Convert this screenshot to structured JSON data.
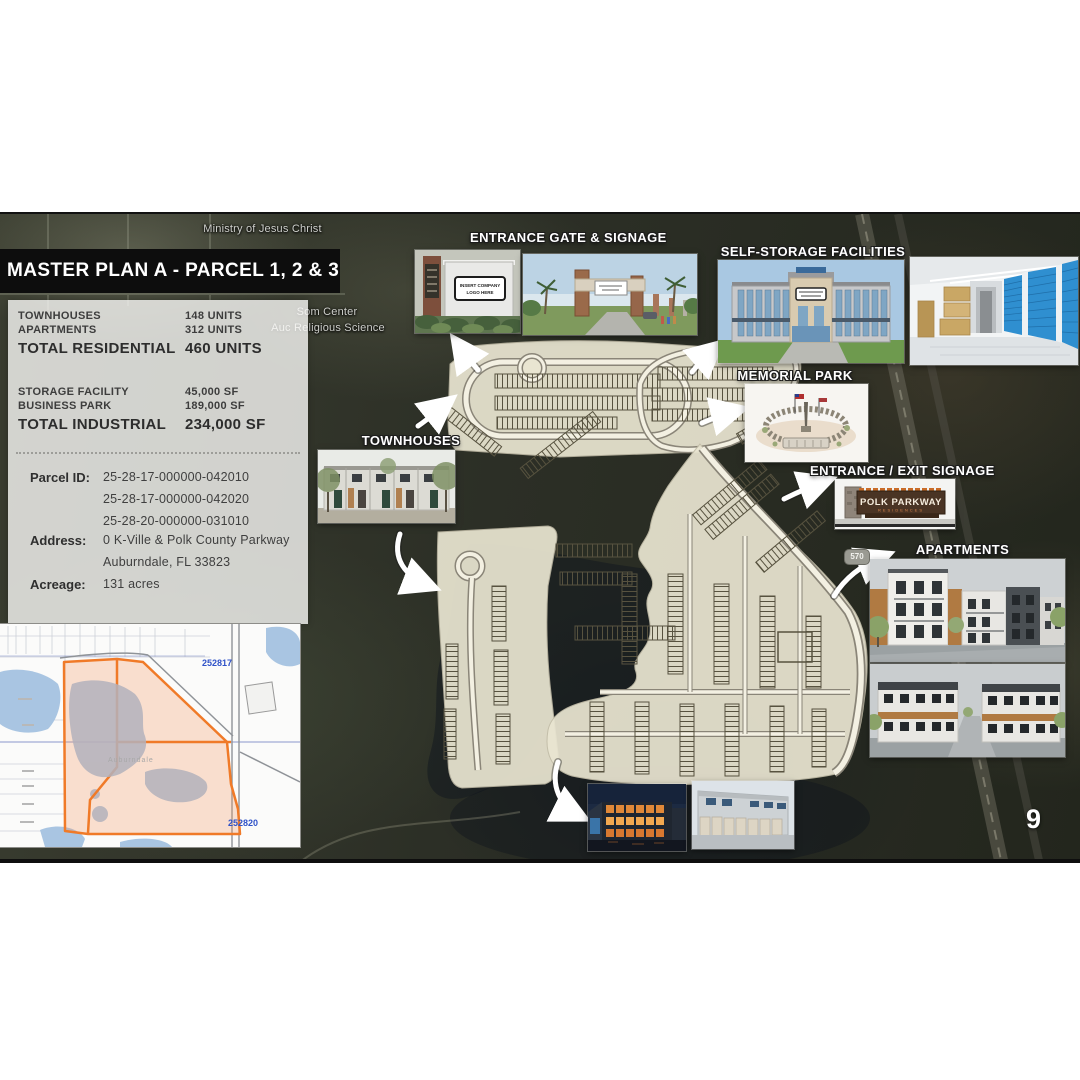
{
  "page_number": "9",
  "aerial": {
    "label_top": "Ministry of Jesus Christ",
    "label_mid1": "Som Center",
    "label_mid2": "Auc Religious Science",
    "road_badge": "570"
  },
  "info_panel": {
    "title": "MASTER PLAN A - PARCEL 1, 2 & 3",
    "residential": {
      "row1": {
        "label": "TOWNHOUSES",
        "value": "148 UNITS"
      },
      "row2": {
        "label": "APARTMENTS",
        "value": "312 UNITS"
      },
      "total": {
        "label": "TOTAL RESIDENTIAL",
        "value": "460 UNITS"
      }
    },
    "industrial": {
      "row1": {
        "label": "STORAGE FACILITY",
        "value": "45,000 SF"
      },
      "row2": {
        "label": "BUSINESS PARK",
        "value": "189,000 SF"
      },
      "total": {
        "label": "TOTAL INDUSTRIAL",
        "value": "234,000 SF"
      }
    },
    "parcel": {
      "label": "Parcel ID:",
      "id1": "25-28-17-000000-042010",
      "id2": "25-28-17-000000-042020",
      "id3": "25-28-20-000000-031010"
    },
    "address": {
      "label": "Address:",
      "line1": "0 K-Ville & Polk County Parkway",
      "line2": "Auburndale, FL 33823"
    },
    "acreage": {
      "label": "Acreage:",
      "value": "131 acres"
    }
  },
  "callouts": {
    "entrance_gate": "ENTRANCE GATE & SIGNAGE",
    "self_storage": "SELF-STORAGE FACILITIES",
    "memorial_park": "MEMORIAL PARK",
    "townhouses": "TOWNHOUSES",
    "entrance_exit": "ENTRANCE / EXIT SIGNAGE",
    "apartments": "APARTMENTS"
  },
  "signs": {
    "logo_line1": "INSERT COMPANY",
    "logo_line2": "LOGO HERE",
    "polk_parkway": "POLK PARKWAY",
    "residences": "RESIDENCES"
  },
  "parcel_map": {
    "label_top_right": "252817",
    "label_bottom_right": "252820",
    "city": "Auburndale"
  },
  "colors": {
    "parcel_orange": "#f07a28",
    "map_label_blue": "#2f52c8",
    "banner_bg": "#0d0d0d"
  }
}
